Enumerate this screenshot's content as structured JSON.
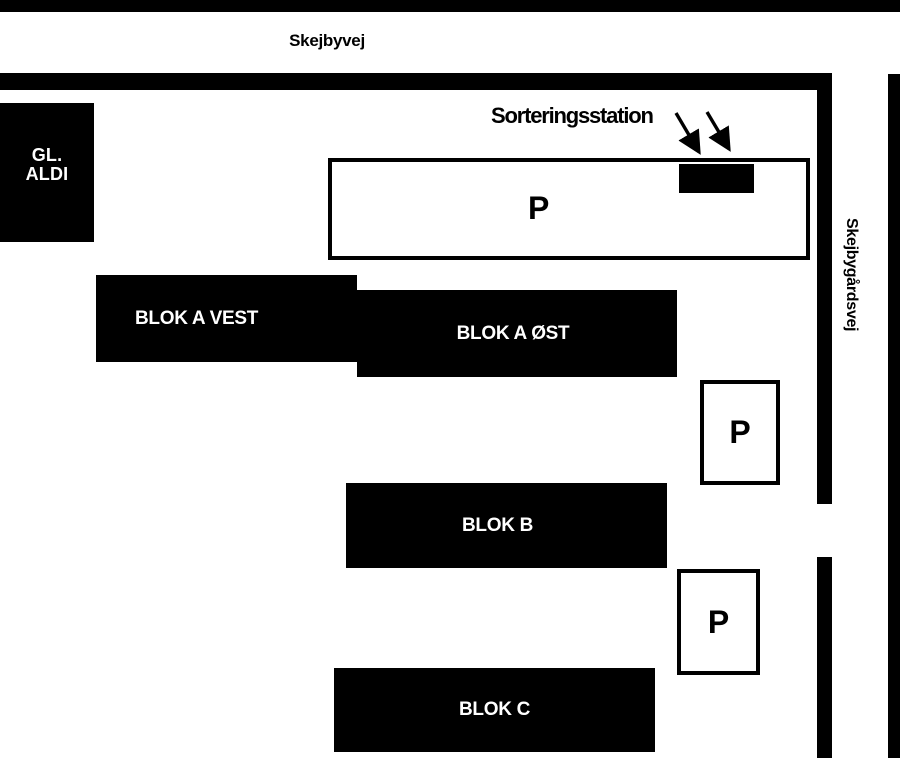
{
  "streets": {
    "skejbyvej": {
      "label": "Skejbyvej"
    },
    "skejbygaardsvej": {
      "label": "Skejbygårdsvej"
    }
  },
  "buildings": {
    "gl_aldi": {
      "line1": "GL.",
      "line2": "ALDI"
    },
    "blok_a_vest": {
      "label": "BLOK A VEST"
    },
    "blok_a_oest": {
      "label": "BLOK A ØST"
    },
    "blok_b": {
      "label": "BLOK B"
    },
    "blok_c": {
      "label": "BLOK C"
    }
  },
  "parking": {
    "main": {
      "label": "P"
    },
    "mid": {
      "label": "P"
    },
    "lower": {
      "label": "P"
    }
  },
  "annotations": {
    "sorting_station": {
      "label": "Sorteringsstation"
    }
  },
  "colors": {
    "road": "#000000",
    "building_fill": "#000000",
    "building_text": "#ffffff",
    "parking_fill": "#ffffff",
    "outline": "#000000",
    "background": "#ffffff"
  }
}
